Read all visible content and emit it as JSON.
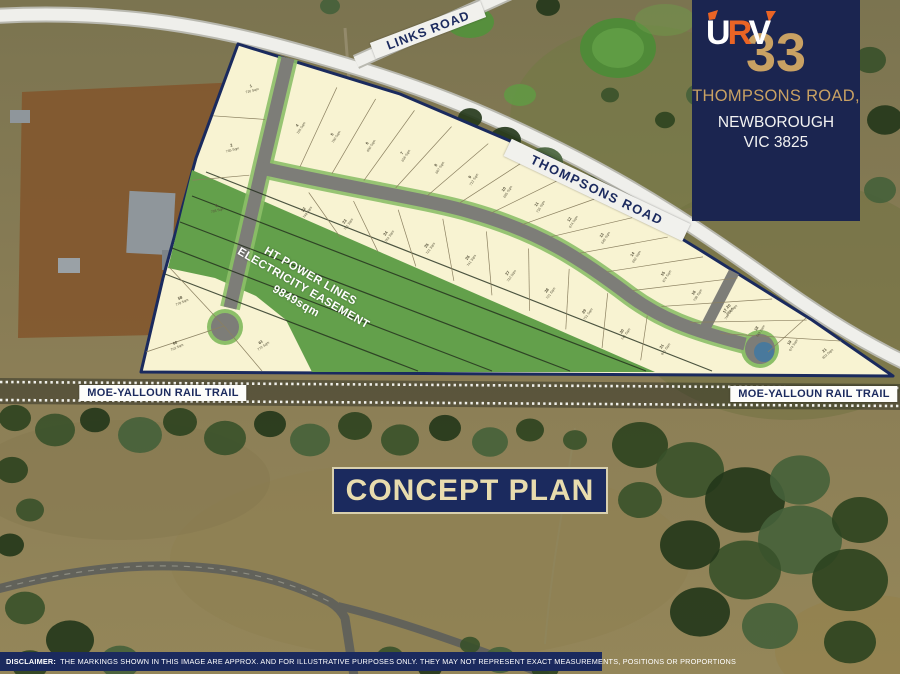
{
  "panel": {
    "logo_letters": [
      "U",
      "R",
      "V"
    ],
    "lot_number": "33",
    "address_line1": "THOMPSONS ROAD,",
    "address_line2": "NEWBOROUGH",
    "address_line3": "VIC 3825"
  },
  "map_labels": {
    "links_road": "LINKS ROAD",
    "thompsons_road": "THOMPSONS ROAD",
    "rail_trail_left": "MOE-YALLOUN RAIL TRAIL",
    "rail_trail_right": "MOE-YALLOUN RAIL TRAIL"
  },
  "easement": {
    "line1": "HT POWER LINES",
    "line2": "ELECTRICITY EASEMENT",
    "line3": "9849sqm"
  },
  "title_box": {
    "title": "CONCEPT PLAN"
  },
  "disclaimer": {
    "label": "DISCLAIMER:",
    "text": " THE MARKINGS SHOWN IN THIS IMAGE ARE APPROX. AND FOR ILLUSTRATIVE PURPOSES ONLY. THEY MAY NOT REPRESENT EXACT MEASUREMENTS, POSITIONS OR PROPORTIONS"
  },
  "colors": {
    "navy": "#1b2a5e",
    "gold": "#c9a163",
    "logo_orange": "#ea6425",
    "lot_cream": "#f8f3d2",
    "easement_green": "#63a04b",
    "road_gray": "#7d7d78",
    "pond_blue": "#49799c"
  },
  "lots": {
    "left_column": [
      {
        "num": "1",
        "area": "726 Sqm"
      },
      {
        "num": "2",
        "area": "745 Sqm"
      },
      {
        "num": "3",
        "area": "703 Sqm"
      }
    ],
    "row_upper": [
      {
        "num": "4",
        "area": "705 Sqm"
      },
      {
        "num": "5",
        "area": "700 Sqm"
      },
      {
        "num": "6",
        "area": "650 Sqm"
      },
      {
        "num": "7",
        "area": "656 Sqm"
      },
      {
        "num": "8",
        "area": "667 Sqm"
      },
      {
        "num": "9",
        "area": "712 Sqm"
      },
      {
        "num": "10",
        "area": "695 Sqm"
      },
      {
        "num": "11",
        "area": "716 Sqm"
      },
      {
        "num": "12",
        "area": "674 Sqm"
      },
      {
        "num": "13",
        "area": "649 Sqm"
      },
      {
        "num": "14",
        "area": "662 Sqm"
      },
      {
        "num": "15",
        "area": "674 Sqm"
      },
      {
        "num": "16",
        "area": "738 Sqm"
      },
      {
        "num": "17",
        "area": "746 Sqm"
      },
      {
        "num": "18",
        "area": "749 Sqm"
      },
      {
        "num": "19",
        "area": "674 Sqm"
      }
    ],
    "row_lower": [
      {
        "num": "22",
        "area": "748 Sqm"
      },
      {
        "num": "23",
        "area": "751 Sqm"
      },
      {
        "num": "24",
        "area": "754 Sqm"
      },
      {
        "num": "25",
        "area": "721 Sqm"
      },
      {
        "num": "26",
        "area": "741 Sqm"
      },
      {
        "num": "27",
        "area": "722 Sqm"
      },
      {
        "num": "28",
        "area": "721 Sqm"
      },
      {
        "num": "29",
        "area": "751 Sqm"
      },
      {
        "num": "30",
        "area": "741 Sqm"
      },
      {
        "num": "31",
        "area": "841 Sqm"
      }
    ],
    "cul_de_sac": [
      {
        "num": "58",
        "area": "778 Sqm"
      },
      {
        "num": "60",
        "area": "702 Sqm"
      },
      {
        "num": "61",
        "area": "772 Sqm"
      }
    ],
    "east_tip": [
      {
        "num": "20",
        "area": "824 Sqm"
      },
      {
        "num": "21",
        "area": "802 Sqm"
      }
    ]
  }
}
